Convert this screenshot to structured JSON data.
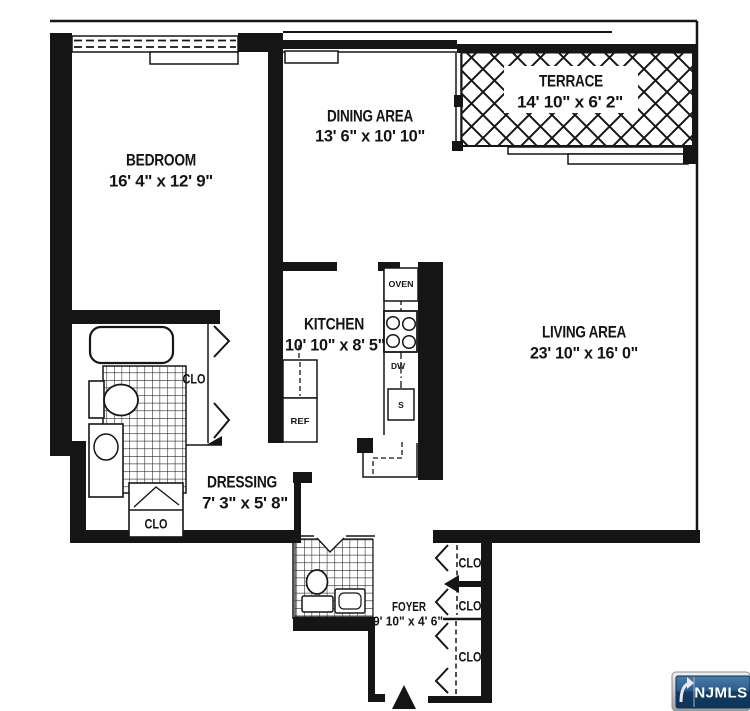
{
  "plan": {
    "rooms": {
      "bedroom": {
        "name": "BEDROOM",
        "dims": "16' 4\" x 12' 9\""
      },
      "dining": {
        "name": "DINING AREA",
        "dims": "13' 6\" x 10' 10\""
      },
      "terrace": {
        "name": "TERRACE",
        "dims": "14' 10\" x 6' 2\""
      },
      "kitchen": {
        "name": "KITCHEN",
        "dims": "10' 10\" x 8' 5\""
      },
      "living": {
        "name": "LIVING AREA",
        "dims": "23' 10\" x 16' 0\""
      },
      "dressing": {
        "name": "DRESSING",
        "dims": "7' 3\" x 5' 8\""
      },
      "foyer": {
        "name": "FOYER",
        "dims": "9' 10\" x 4' 6\""
      }
    },
    "closets": {
      "bedroom": "CLO",
      "dressing": "CLO",
      "foyer1": "CLO",
      "foyer2": "CLO",
      "foyer3": "CLO"
    },
    "appliances": {
      "oven": "OVEN",
      "dishwasher": "DW",
      "sink": "S",
      "refrigerator": "REF"
    },
    "colors": {
      "wall": "#151515",
      "background": "#ffffff",
      "badge_blue": "#123c66",
      "badge_silver": "#c9c9c9"
    }
  },
  "watermark": {
    "label": "NJMLS"
  }
}
